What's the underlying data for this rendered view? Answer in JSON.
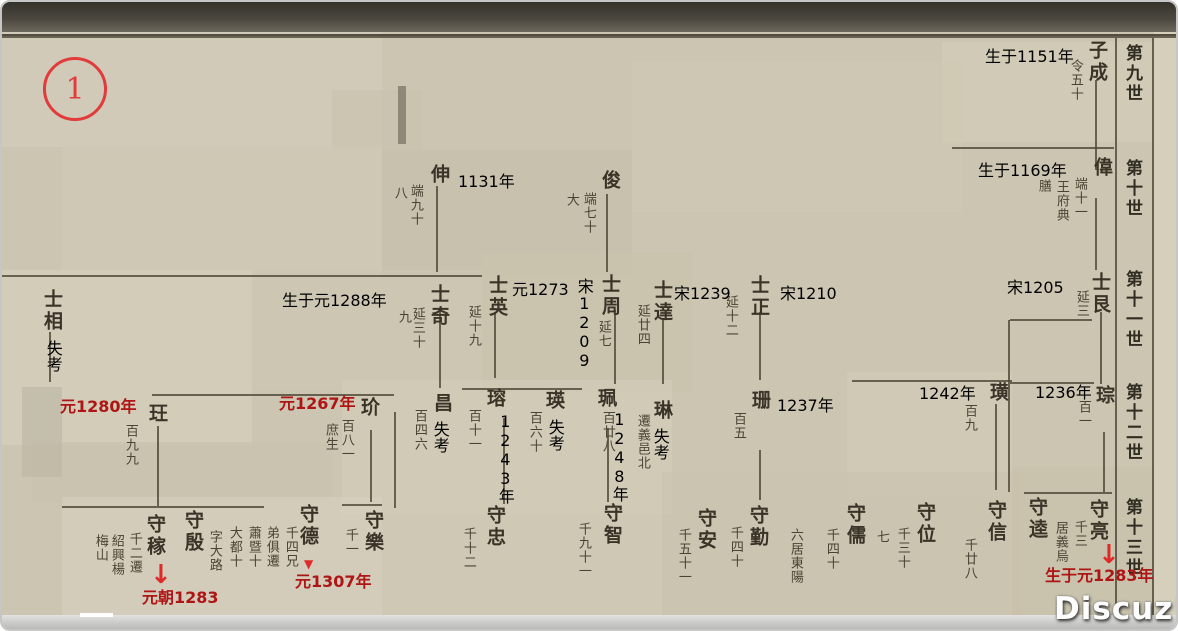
{
  "frame": {
    "circle_label": "1",
    "watermark_text": "Discuz!",
    "accent_red": "#ae1515",
    "paper_color": "#ccc5b1",
    "ink_color": "#3a3428"
  },
  "generation_headers": [
    {
      "t": "第九世",
      "x": 1121,
      "y": 42
    },
    {
      "t": "第十世",
      "x": 1121,
      "y": 157
    },
    {
      "t": "第十一世",
      "x": 1121,
      "y": 268
    },
    {
      "t": "第十二世",
      "x": 1121,
      "y": 381
    },
    {
      "t": "第十三世",
      "x": 1121,
      "y": 496
    }
  ],
  "persons": [
    {
      "name": "子成",
      "x": 1085,
      "y": 38,
      "notes": [
        {
          "t": "令五十",
          "x": 1064,
          "y": 57
        }
      ]
    },
    {
      "name": "偉",
      "x": 1090,
      "y": 155,
      "notes": [
        {
          "t": "端十一",
          "x": 1068,
          "y": 175
        },
        {
          "t": "王府典",
          "x": 1050,
          "y": 178
        },
        {
          "t": "膳",
          "x": 1032,
          "y": 177
        }
      ]
    },
    {
      "name": "俊",
      "x": 598,
      "y": 168,
      "notes": [
        {
          "t": "端七十",
          "x": 577,
          "y": 190
        },
        {
          "t": "大",
          "x": 560,
          "y": 191
        }
      ]
    },
    {
      "name": "伸",
      "x": 427,
      "y": 162,
      "notes": [
        {
          "t": "端九十",
          "x": 404,
          "y": 182
        },
        {
          "t": "八",
          "x": 388,
          "y": 184
        }
      ]
    },
    {
      "name": "士艮",
      "x": 1088,
      "y": 270,
      "notes": [
        {
          "t": "延三",
          "x": 1070,
          "y": 288
        }
      ]
    },
    {
      "name": "士正",
      "x": 747,
      "y": 273,
      "notes": [
        {
          "t": "延十二",
          "x": 719,
          "y": 293
        }
      ]
    },
    {
      "name": "士達",
      "x": 650,
      "y": 278,
      "notes": [
        {
          "t": "延廿四",
          "x": 631,
          "y": 302
        }
      ]
    },
    {
      "name": "士周",
      "x": 598,
      "y": 272,
      "notes": [
        {
          "t": "延七",
          "x": 592,
          "y": 318
        }
      ]
    },
    {
      "name": "士英",
      "x": 485,
      "y": 273,
      "notes": [
        {
          "t": "延十九",
          "x": 462,
          "y": 303
        }
      ]
    },
    {
      "name": "士奇",
      "x": 427,
      "y": 282,
      "notes": [
        {
          "t": "延三十",
          "x": 406,
          "y": 305
        },
        {
          "t": "九",
          "x": 392,
          "y": 308
        }
      ]
    },
    {
      "name": "士相",
      "x": 40,
      "y": 287,
      "notes": []
    },
    {
      "name": "琮",
      "x": 1092,
      "y": 383,
      "notes": [
        {
          "t": "百一",
          "x": 1072,
          "y": 398
        }
      ]
    },
    {
      "name": "璜",
      "x": 986,
      "y": 380,
      "notes": [
        {
          "t": "百九",
          "x": 958,
          "y": 402
        }
      ]
    },
    {
      "name": "珊",
      "x": 748,
      "y": 388,
      "notes": [
        {
          "t": "百五",
          "x": 727,
          "y": 410
        }
      ]
    },
    {
      "name": "琳",
      "x": 650,
      "y": 398,
      "notes": [
        {
          "t": "遷義邑北",
          "x": 631,
          "y": 412
        }
      ]
    },
    {
      "name": "珮",
      "x": 594,
      "y": 386,
      "notes": [
        {
          "t": "百廿八",
          "x": 596,
          "y": 409
        }
      ]
    },
    {
      "name": "瑛",
      "x": 542,
      "y": 388,
      "notes": [
        {
          "t": "百六十",
          "x": 523,
          "y": 409
        }
      ]
    },
    {
      "name": "瑢",
      "x": 483,
      "y": 386,
      "notes": [
        {
          "t": "百十一",
          "x": 462,
          "y": 407
        }
      ]
    },
    {
      "name": "昌",
      "x": 430,
      "y": 391,
      "notes": [
        {
          "t": "百四六",
          "x": 408,
          "y": 407
        }
      ]
    },
    {
      "name": "玠",
      "x": 357,
      "y": 395,
      "notes": [
        {
          "t": "百八一",
          "x": 335,
          "y": 417
        },
        {
          "t": "庶生",
          "x": 319,
          "y": 421
        }
      ]
    },
    {
      "name": "玨",
      "x": 145,
      "y": 401,
      "notes": [
        {
          "t": "百九九",
          "x": 119,
          "y": 422
        }
      ]
    },
    {
      "name": "守亮",
      "x": 1086,
      "y": 497,
      "notes": [
        {
          "t": "千三",
          "x": 1068,
          "y": 518
        },
        {
          "t": "居義烏",
          "x": 1049,
          "y": 519
        }
      ]
    },
    {
      "name": "守逵",
      "x": 1025,
      "y": 495,
      "notes": []
    },
    {
      "name": "守信",
      "x": 984,
      "y": 498,
      "notes": [
        {
          "t": "千廿八",
          "x": 958,
          "y": 536
        }
      ]
    },
    {
      "name": "守位",
      "x": 913,
      "y": 500,
      "notes": [
        {
          "t": "千三十",
          "x": 891,
          "y": 525
        },
        {
          "t": "七",
          "x": 870,
          "y": 528
        }
      ]
    },
    {
      "name": "守儒",
      "x": 843,
      "y": 501,
      "notes": [
        {
          "t": "千四十",
          "x": 820,
          "y": 526
        },
        {
          "t": "六居東陽",
          "x": 784,
          "y": 526
        }
      ]
    },
    {
      "name": "守勤",
      "x": 746,
      "y": 503,
      "notes": [
        {
          "t": "千四十",
          "x": 724,
          "y": 524
        }
      ]
    },
    {
      "name": "守安",
      "x": 694,
      "y": 506,
      "notes": [
        {
          "t": "千五十一",
          "x": 672,
          "y": 526
        }
      ]
    },
    {
      "name": "守智",
      "x": 600,
      "y": 501,
      "notes": [
        {
          "t": "千九十一",
          "x": 572,
          "y": 520
        }
      ]
    },
    {
      "name": "守忠",
      "x": 483,
      "y": 503,
      "notes": [
        {
          "t": "千十二",
          "x": 457,
          "y": 525
        }
      ]
    },
    {
      "name": "守樂",
      "x": 361,
      "y": 508,
      "notes": [
        {
          "t": "千一",
          "x": 339,
          "y": 526
        }
      ]
    },
    {
      "name": "守德",
      "x": 296,
      "y": 502,
      "notes": [
        {
          "t": "千四兄",
          "x": 279,
          "y": 524
        },
        {
          "t": "弟俱遷",
          "x": 260,
          "y": 524
        },
        {
          "t": "蕭暨十",
          "x": 242,
          "y": 524
        },
        {
          "t": "大都十",
          "x": 223,
          "y": 524
        }
      ]
    },
    {
      "name": "守殷",
      "x": 181,
      "y": 508,
      "notes": [
        {
          "t": "字大路",
          "x": 203,
          "y": 528
        }
      ]
    },
    {
      "name": "守稼",
      "x": 143,
      "y": 512,
      "notes": [
        {
          "t": "千二遷",
          "x": 123,
          "y": 530
        },
        {
          "t": "紹興楊",
          "x": 105,
          "y": 532
        },
        {
          "t": "梅山",
          "x": 89,
          "y": 532
        }
      ]
    }
  ],
  "typed_notes_black": [
    {
      "t": "生于1151年",
      "x": 983,
      "y": 47
    },
    {
      "t": "生于1169年",
      "x": 976,
      "y": 161
    },
    {
      "t": "1131年",
      "x": 456,
      "y": 172
    },
    {
      "t": "生于元1288年",
      "x": 280,
      "y": 291
    },
    {
      "t": "元1273",
      "x": 510,
      "y": 280
    },
    {
      "t": "宋1239",
      "x": 672,
      "y": 284
    },
    {
      "t": "宋1210",
      "x": 778,
      "y": 284
    },
    {
      "t": "宋1205",
      "x": 1005,
      "y": 278
    },
    {
      "t": "1236年",
      "x": 1033,
      "y": 383
    },
    {
      "t": "1242年",
      "x": 917,
      "y": 384
    },
    {
      "t": "1237年",
      "x": 775,
      "y": 396
    },
    {
      "t": "宋1209",
      "x": 573,
      "y": 276,
      "vertical": true
    },
    {
      "t": "1243年",
      "x": 494,
      "y": 410,
      "vertical": true
    },
    {
      "t": "1248年",
      "x": 608,
      "y": 408,
      "vertical": true
    },
    {
      "t": "失考",
      "x": 42,
      "y": 338,
      "vertical": true
    },
    {
      "t": "失考",
      "x": 429,
      "y": 419,
      "vertical": true
    },
    {
      "t": "失考",
      "x": 544,
      "y": 417,
      "vertical": true
    },
    {
      "t": "失考",
      "x": 649,
      "y": 426,
      "vertical": true
    }
  ],
  "typed_notes_red": [
    {
      "t": "元1280年",
      "x": 58,
      "y": 397
    },
    {
      "t": "元1267年",
      "x": 277,
      "y": 394
    },
    {
      "t": "元1307年",
      "x": 293,
      "y": 572
    },
    {
      "t": "元朝1283",
      "x": 140,
      "y": 588
    },
    {
      "t": "生于元1283年",
      "x": 1043,
      "y": 566
    }
  ],
  "red_arrows": [
    {
      "glyph": "↓",
      "x": 148,
      "y": 560,
      "size": 26
    },
    {
      "glyph": "▼",
      "x": 302,
      "y": 556,
      "size": 12
    },
    {
      "glyph": "↓",
      "x": 1096,
      "y": 540,
      "size": 26
    }
  ],
  "connector_lines": {
    "vertical": [
      {
        "x": 1093,
        "y": 78,
        "len": 90
      },
      {
        "x": 1093,
        "y": 196,
        "len": 72
      },
      {
        "x": 1098,
        "y": 310,
        "len": 72
      },
      {
        "x": 1101,
        "y": 430,
        "len": 60
      },
      {
        "x": 604,
        "y": 192,
        "len": 78
      },
      {
        "x": 434,
        "y": 184,
        "len": 86
      },
      {
        "x": 757,
        "y": 310,
        "len": 68
      },
      {
        "x": 660,
        "y": 318,
        "len": 64
      },
      {
        "x": 612,
        "y": 308,
        "len": 74
      },
      {
        "x": 492,
        "y": 310,
        "len": 66
      },
      {
        "x": 437,
        "y": 308,
        "len": 78
      },
      {
        "x": 47,
        "y": 330,
        "len": 50
      },
      {
        "x": 155,
        "y": 424,
        "len": 80
      },
      {
        "x": 368,
        "y": 428,
        "len": 72
      },
      {
        "x": 501,
        "y": 416,
        "len": 86
      },
      {
        "x": 605,
        "y": 426,
        "len": 74
      },
      {
        "x": 757,
        "y": 448,
        "len": 50
      },
      {
        "x": 993,
        "y": 402,
        "len": 86
      },
      {
        "x": 392,
        "y": 410,
        "len": 96
      },
      {
        "x": 1006,
        "y": 318,
        "len": 172
      },
      {
        "x": 1113,
        "y": 36,
        "len": 576
      },
      {
        "x": 1150,
        "y": 36,
        "len": 580
      }
    ],
    "horizontal": [
      {
        "x": 0,
        "y": 34,
        "len": 1178
      },
      {
        "x": 950,
        "y": 145,
        "len": 162
      },
      {
        "x": 0,
        "y": 273,
        "len": 480
      },
      {
        "x": 1008,
        "y": 317,
        "len": 82
      },
      {
        "x": 150,
        "y": 392,
        "len": 242
      },
      {
        "x": 460,
        "y": 386,
        "len": 120
      },
      {
        "x": 850,
        "y": 378,
        "len": 160
      },
      {
        "x": 1008,
        "y": 380,
        "len": 84
      },
      {
        "x": 60,
        "y": 504,
        "len": 202
      },
      {
        "x": 340,
        "y": 502,
        "len": 40
      },
      {
        "x": 1022,
        "y": 490,
        "len": 88
      },
      {
        "x": 340,
        "y": 615,
        "len": 810
      }
    ]
  },
  "paper_patches": [
    {
      "x": 0,
      "y": 30,
      "w": 380,
      "h": 115,
      "c": "#d4cdbb"
    },
    {
      "x": 940,
      "y": 40,
      "w": 212,
      "h": 100,
      "c": "#d3ccb9"
    },
    {
      "x": 330,
      "y": 88,
      "w": 90,
      "h": 60,
      "c": "#c9c2ae"
    },
    {
      "x": 380,
      "y": 148,
      "w": 250,
      "h": 125,
      "c": "#c6bfaa"
    },
    {
      "x": 630,
      "y": 60,
      "w": 330,
      "h": 150,
      "c": "#cfc8b4"
    },
    {
      "x": 60,
      "y": 145,
      "w": 320,
      "h": 125,
      "c": "#cfc9b6"
    },
    {
      "x": 0,
      "y": 268,
      "w": 250,
      "h": 175,
      "c": "#d6cfbd"
    },
    {
      "x": 250,
      "y": 268,
      "w": 230,
      "h": 120,
      "c": "#cdc6b2"
    },
    {
      "x": 480,
      "y": 250,
      "w": 210,
      "h": 140,
      "c": "#c9c3ae"
    },
    {
      "x": 690,
      "y": 240,
      "w": 330,
      "h": 145,
      "c": "#ccc5b0"
    },
    {
      "x": 845,
      "y": 370,
      "w": 165,
      "h": 125,
      "c": "#d2cbb8"
    },
    {
      "x": 340,
      "y": 378,
      "w": 330,
      "h": 135,
      "c": "#d2ccba"
    },
    {
      "x": 30,
      "y": 440,
      "w": 300,
      "h": 60,
      "c": "#c8c2ae"
    },
    {
      "x": 60,
      "y": 495,
      "w": 320,
      "h": 132,
      "c": "#d7d0be"
    },
    {
      "x": 380,
      "y": 490,
      "w": 280,
      "h": 135,
      "c": "#cfc9b5"
    },
    {
      "x": 660,
      "y": 470,
      "w": 360,
      "h": 150,
      "c": "#cac3af"
    },
    {
      "x": 1010,
      "y": 465,
      "w": 142,
      "h": 160,
      "c": "#c7c0ab"
    },
    {
      "x": 1152,
      "y": 30,
      "w": 26,
      "h": 600,
      "c": "#dad4c2"
    },
    {
      "x": 20,
      "y": 385,
      "w": 40,
      "h": 90,
      "c": "#bdb7a5"
    },
    {
      "x": 396,
      "y": 84,
      "w": 8,
      "h": 58,
      "c": "#6e695b"
    }
  ]
}
